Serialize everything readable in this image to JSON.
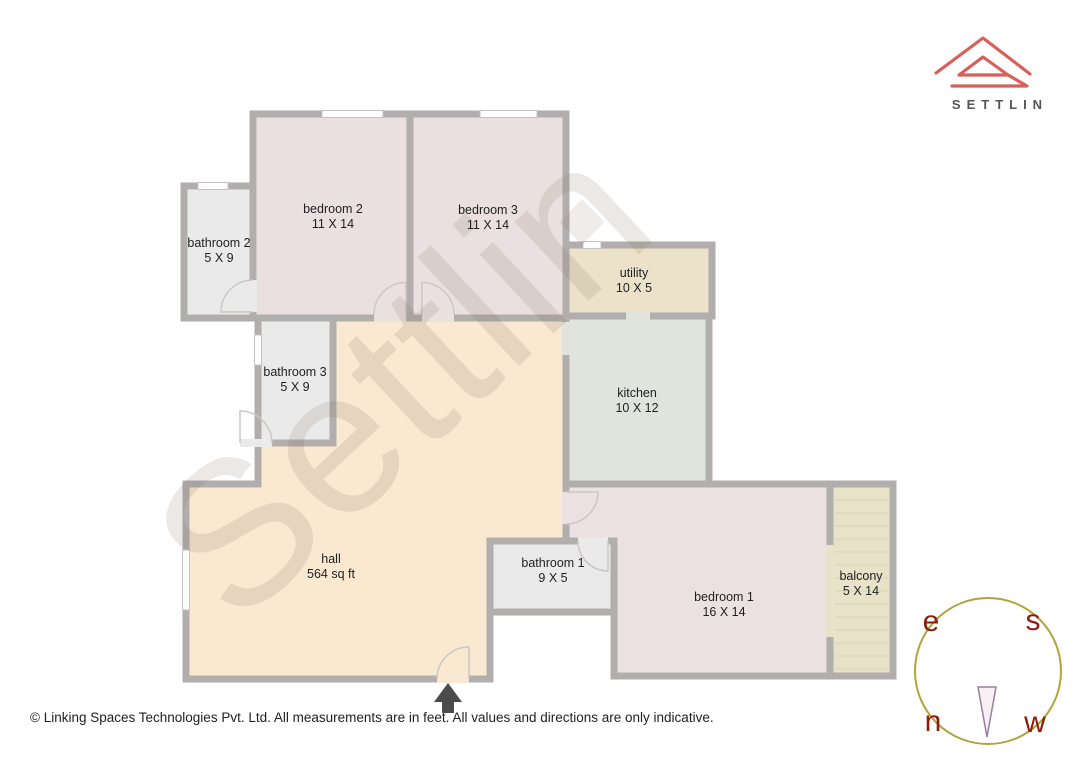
{
  "brand": {
    "logo_text": "SETTLIN"
  },
  "watermark_text": "Settlin",
  "rooms": [
    {
      "name": "bedroom 2",
      "dims": "11 X 14"
    },
    {
      "name": "bedroom 3",
      "dims": "11 X 14"
    },
    {
      "name": "bathroom 2",
      "dims": "5 X 9"
    },
    {
      "name": "utility",
      "dims": "10 X 5"
    },
    {
      "name": "kitchen",
      "dims": "10 X 12"
    },
    {
      "name": "bathroom 3",
      "dims": "5 X 9"
    },
    {
      "name": "hall",
      "dims": "564 sq ft"
    },
    {
      "name": "bathroom 1",
      "dims": "9 X 5"
    },
    {
      "name": "bedroom 1",
      "dims": "16 X 14"
    },
    {
      "name": "balcony",
      "dims": "5 X 14"
    }
  ],
  "compass": {
    "top_left": "e",
    "top_right": "s",
    "bottom_left": "n",
    "bottom_right": "w"
  },
  "footer_text": "© Linking Spaces Technologies Pvt. Ltd. All measurements are in feet. All values and directions are only indicative.",
  "colors": {
    "wall": "#b2aeae",
    "bedroom_fill": "#ebe0e0",
    "bathroom_fill": "#eaeaea",
    "utility_fill": "#ebe2c9",
    "kitchen_fill": "#e1e3dd",
    "hall_fill": "#f9e9d1",
    "balcony_fill": "#e8e3c8",
    "logo_red": "#d85f5a",
    "compass_ring": "#b3a33c",
    "compass_letters": "#8b1c10",
    "entrance_arrow": "#4b4b4b"
  }
}
